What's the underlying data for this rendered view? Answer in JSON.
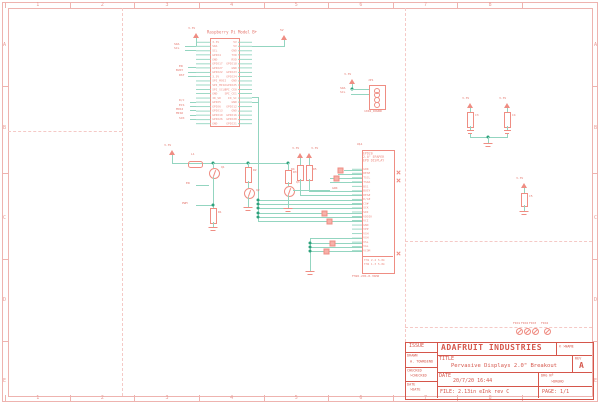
{
  "colors": {
    "component_red": "#ef8d83",
    "net_green": "#93d5c0",
    "frame_pink": "#eeb3af",
    "title_red": "#d5564b"
  },
  "frame": {
    "columns": [
      "1",
      "2",
      "3",
      "4",
      "5",
      "6",
      "7",
      "8"
    ],
    "rows": [
      "A",
      "B",
      "C",
      "D",
      "E"
    ]
  },
  "rpi": {
    "title": "Raspberry Pi Model B+",
    "left_pins": [
      "3.3V",
      "SDA",
      "SCL",
      "GPIO4",
      "GND",
      "GPIO17",
      "GPIO27",
      "GPIO22",
      "3.3V",
      "SPI_MOSI",
      "SPI_MISO",
      "SPI_SCLK",
      "GND",
      "ID_SD",
      "GPIO5",
      "GPIO6",
      "GPIO13",
      "GPIO19",
      "GPIO26",
      "GND"
    ],
    "right_pins": [
      "5V",
      "5V",
      "GND",
      "TXD",
      "RXD",
      "GPIO18",
      "GND",
      "GPIO23",
      "GPIO24",
      "GND",
      "GPIO25",
      "SPI_CE0",
      "SPI_CE1",
      "ID_SC",
      "GND",
      "GPIO12",
      "GND",
      "GPIO16",
      "GPIO20",
      "GPIO21"
    ],
    "net_labels": [
      "SDA",
      "SCL",
      "EN",
      "BUSY",
      "RST",
      "D/C",
      "ECS",
      "MOSI",
      "MISO",
      "SCK"
    ],
    "supply_left": "3.3V",
    "supply_right": "5V"
  },
  "jp1": {
    "ref": "JP1",
    "part": "1X04_ROUND",
    "net_labels": [
      "SDA",
      "SCL"
    ],
    "supply": "3.3V"
  },
  "epd": {
    "ref": "U$1",
    "name_lines": [
      "EPD20",
      "2.0\" EPAPER",
      "EPD DISPLAY"
    ],
    "pins": [
      "GDR",
      "RESE",
      "TSCL",
      "TSDA",
      "BS1",
      "BUSY",
      "RES#",
      "D/C#",
      "CS#",
      "SCK",
      "SDI",
      "VDDIO",
      "VCI",
      "GND",
      "VPP",
      "VSH",
      "VGH",
      "VSL",
      "VGL",
      "VCOM"
    ],
    "bottom_rows": [
      "TH1  2.4  5.0k",
      "TH2  1.3  5.0k"
    ],
    "part": "FH26-29S-0.3SHW"
  },
  "driver": {
    "l1": "L1",
    "q1": "Q1",
    "q2": "Q2",
    "q3": "Q3",
    "r1": "R1",
    "r2": "R2",
    "r3": "R3",
    "r4": "R4",
    "r5": "R5",
    "en": "EN",
    "pwm": "PWM",
    "gdr": "GDR"
  },
  "caps": {
    "c3": "C3",
    "c4": "C4",
    "c5": "C5"
  },
  "power": {
    "v33": "3.3V",
    "v5": "5V"
  },
  "fiducials": [
    "FID1",
    "FID2",
    "FID3",
    "FID4"
  ],
  "title_block": {
    "issue": "ISSUE",
    "drawn_label": "DRAWN",
    "drawn": "A. TOWNSEND",
    "checked_label": "CHECKED",
    "checked": ">CHECKED",
    "date_side_label": "DATE",
    "date_side": ">DATE",
    "company": "ADAFRUIT INDUSTRIES",
    "copyright": "© >NAME",
    "title_label": "TITLE",
    "title": "Pervasive Displays 2.0\" Breakout",
    "rev_label": "REV",
    "rev": "A",
    "date_label": "DATE",
    "date": "20/7/20 16:44",
    "drg_label": "DRG Nº",
    "drg": ">DRGNO",
    "file": "FILE: 2.13in eInk rev C",
    "page": "PAGE: 1/1"
  }
}
